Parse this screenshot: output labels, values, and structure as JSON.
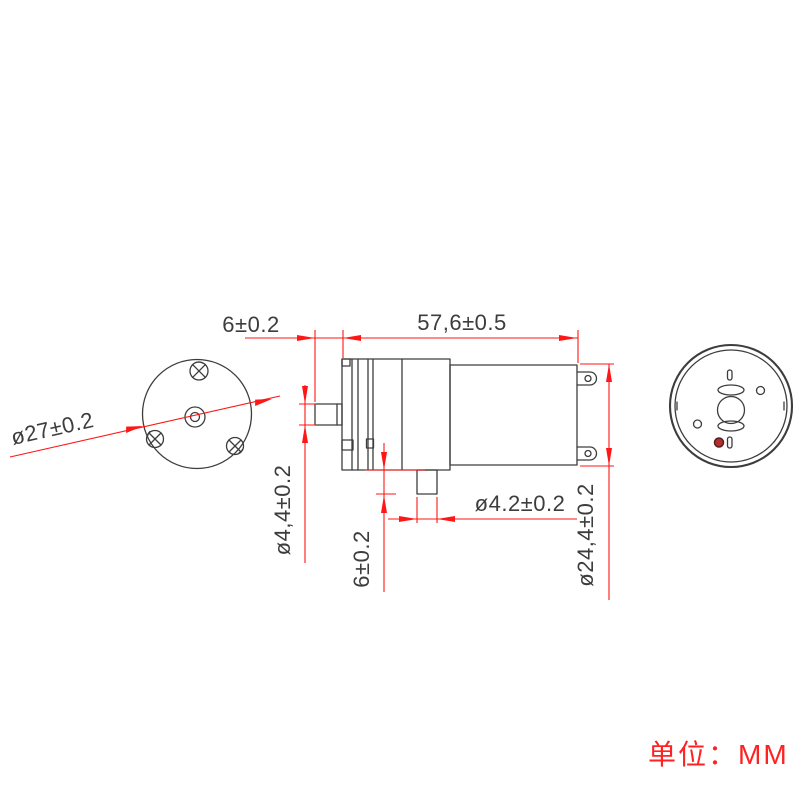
{
  "drawing": {
    "title_hint": "micro pump technical drawing",
    "unit_label": "单位：MM",
    "front_view": {
      "diameter_label": "ø27±0.2"
    },
    "side_view": {
      "nozzle_offset_label": "6±0.2",
      "body_length_label": "57,6±0.5",
      "left_nozzle_diameter_label": "ø4,4±0.2",
      "bottom_nozzle_length_label": "6±0.2",
      "bottom_nozzle_diameter_label": "ø4.2±0.2",
      "motor_diameter_label": "ø24,4±0.2"
    },
    "colors": {
      "dimension_red": "#ff1616",
      "geometry_gray": "#3d3d3d",
      "unit_text_red": "#ff2222",
      "marker_dot_red": "#b03030"
    }
  }
}
